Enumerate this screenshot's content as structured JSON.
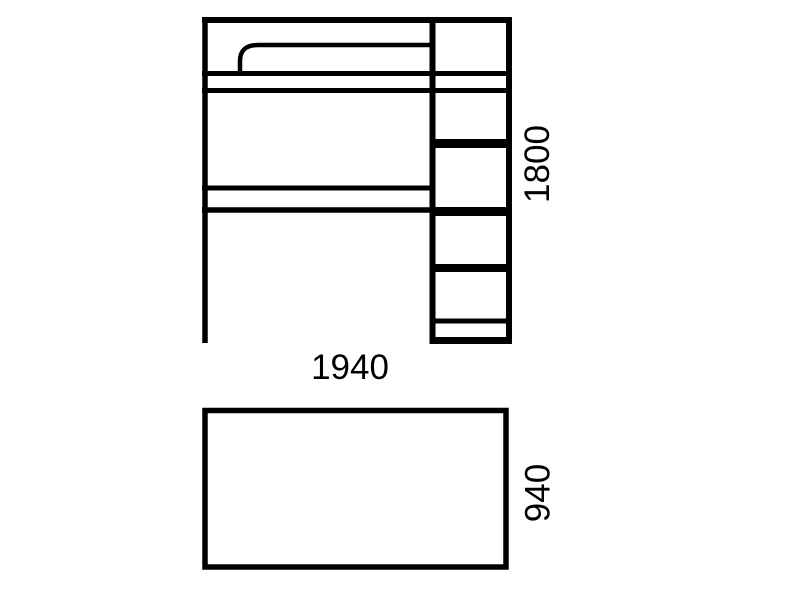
{
  "colors": {
    "background": "#ffffff",
    "ink": "#000000"
  },
  "dimensions": {
    "front_width": "1940",
    "front_height": "1800",
    "top_depth": "940"
  }
}
